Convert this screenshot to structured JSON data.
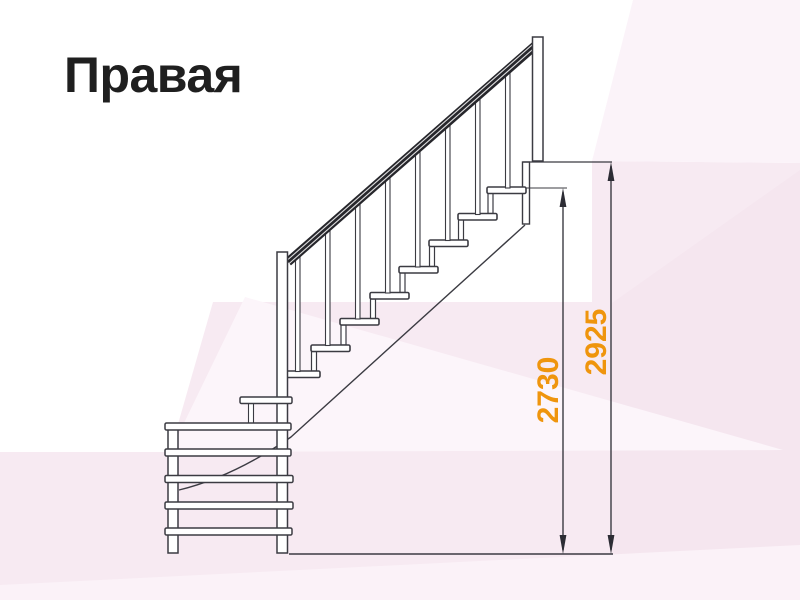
{
  "title": "Правая",
  "diagram": {
    "type": "staircase-side-elevation",
    "dimensions": {
      "flight_height_mm": "2730",
      "total_height_mm": "2925"
    },
    "colors": {
      "dimension_label": "#EF950D",
      "drawing_line": "#3B3B42",
      "dimension_line": "#2C2C34",
      "handrail": "#26262B",
      "background_tint": "#F7EAF2",
      "title_text": "#1F1F1F"
    }
  }
}
